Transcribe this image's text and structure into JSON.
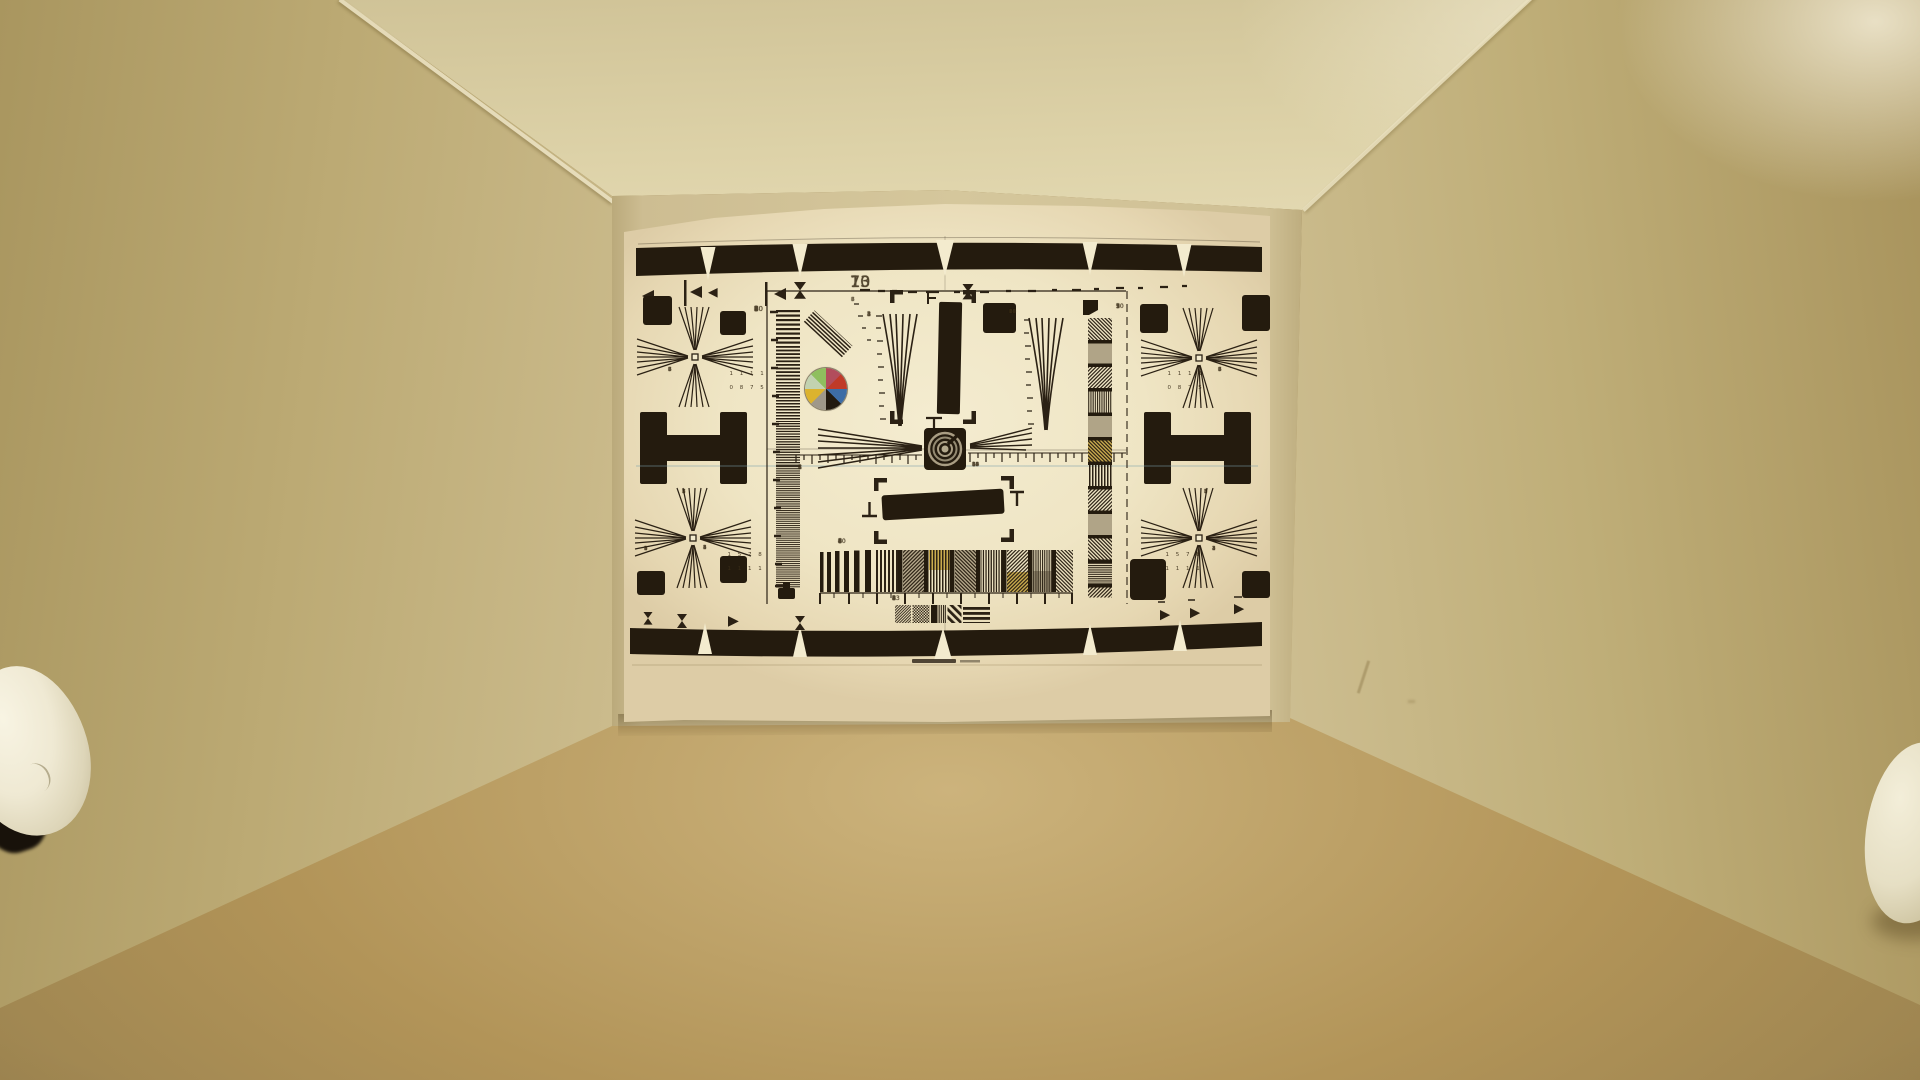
{
  "scene": {
    "description": "Warm tungsten-lit test box interior with an ITE-style resolution test chart mounted on the back wall; white dome reflectors visible at the lower left corner and right edge.",
    "colors": {
      "ceiling": "#ddd2a8",
      "left_wall": "#bcaa74",
      "right_wall": "#bfae78",
      "back_wall": "#d5c79c",
      "floor": "#b29458",
      "floor_highlight": "#ccb37c",
      "paper": "#f2e9cb",
      "ink": "#2b2114",
      "dome_white": "#f2eedd",
      "corner_glow": "#f0e8ca",
      "seam_line": "#7ba0ad"
    }
  },
  "chart": {
    "type_hint": "resolution-test-chart",
    "top_scale_numbers": [
      "7",
      "10",
      "13"
    ],
    "left_strip_numbers": [
      "1",
      "2",
      "3",
      "4",
      "5",
      "6",
      "7",
      "8",
      "9",
      "10"
    ],
    "left_fan_scale": [
      "1",
      "2",
      "3",
      "4",
      "5"
    ],
    "right_fan_scale": [
      "2",
      "3",
      "4",
      "6",
      "9",
      "12",
      "14",
      "18",
      "20"
    ],
    "left_ruler_numbers": [
      "1",
      "2",
      "3",
      "4"
    ],
    "right_ruler_numbers": [
      "16",
      "15",
      "14",
      "12",
      "10",
      "8",
      "6"
    ],
    "sweep_top_numbers": [
      "3",
      "4",
      "5",
      "6",
      "7",
      "8",
      "10",
      "8",
      "6",
      "4"
    ],
    "sweep_bottom_numbers": [
      "2",
      "3",
      "4",
      "5",
      "6",
      "8",
      "13"
    ],
    "right_strip_numbers": [
      "1",
      "3",
      "5",
      "7",
      "9",
      "10"
    ],
    "cross_side_numbers_top": [
      "5",
      "6",
      "7",
      "8"
    ],
    "cross_side_numbers_bottom": [
      "1",
      "7",
      "8",
      "5"
    ],
    "cross_corner_row": [
      "1",
      "2",
      "3",
      "4"
    ],
    "cross_corner_col": [
      "5",
      "4",
      "1",
      "2"
    ],
    "wedge_numbers": [
      "8",
      "7",
      "6",
      "5"
    ],
    "cross_labels_top": {
      "row1": "1 1 1 1",
      "row2": "0 8 7 5"
    },
    "cross_labels_bottom": {
      "row1": "1 5 7 8",
      "row2": "1 1 1 1"
    },
    "color_wheel": {
      "segments": [
        {
          "name": "rose-red",
          "hex": "#b24d5c"
        },
        {
          "name": "red",
          "hex": "#c03a28"
        },
        {
          "name": "blue",
          "hex": "#3d6ca5"
        },
        {
          "name": "black",
          "hex": "#221a10"
        },
        {
          "name": "gray",
          "hex": "#9f988a"
        },
        {
          "name": "yellow",
          "hex": "#dcb32e"
        },
        {
          "name": "pale-green",
          "hex": "#c2d2b0"
        },
        {
          "name": "green",
          "hex": "#8fbf5e"
        }
      ]
    }
  }
}
